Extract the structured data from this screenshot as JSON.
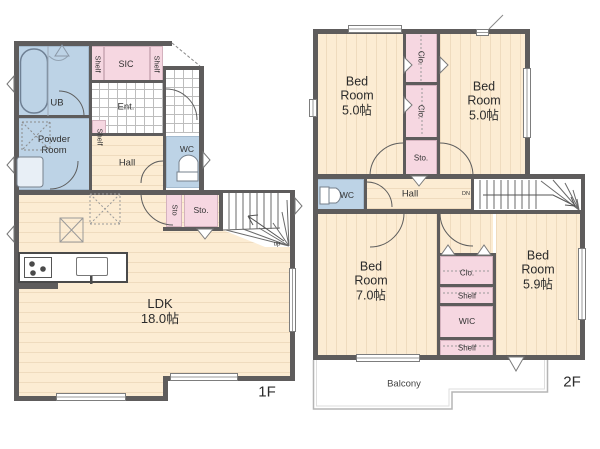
{
  "floor1": {
    "floor_label": "1F",
    "rooms": {
      "ub": "UB",
      "shelf_a": "Shelf",
      "sic": "SIC",
      "shelf_b": "Shelf",
      "ent": "Ent.",
      "powder": "Powder\nRoom",
      "shelf_c": "Shelf",
      "hall": "Hall",
      "wc": "WC",
      "sto_small": "Sto",
      "sto": "Sto.",
      "stairs_dir": "up",
      "ldk": "LDK\n18.0帖"
    }
  },
  "floor2": {
    "floor_label": "2F",
    "rooms": {
      "bed_nw": "Bed\nRoom\n5.0帖",
      "clo_top": "Clo.",
      "clo_mid": "Clo.",
      "sto": "Sto.",
      "bed_ne": "Bed\nRoom\n5.0帖",
      "wc": "WC",
      "hall": "Hall",
      "stairs_dir": "DN",
      "bed_sw": "Bed\nRoom\n7.0帖",
      "clo": "Clo.",
      "shelf_top": "Shelf",
      "wic": "WIC",
      "shelf_bottom": "Shelf",
      "bed_se": "Bed\nRoom\n5.9帖",
      "balcony": "Balcony"
    }
  },
  "colors": {
    "wall": "#5e5c5c",
    "floor_wood": "#fcecd3",
    "room_blue": "#bdd3e6",
    "room_pink": "#f6d7e1",
    "tile_white": "#ffffff"
  }
}
